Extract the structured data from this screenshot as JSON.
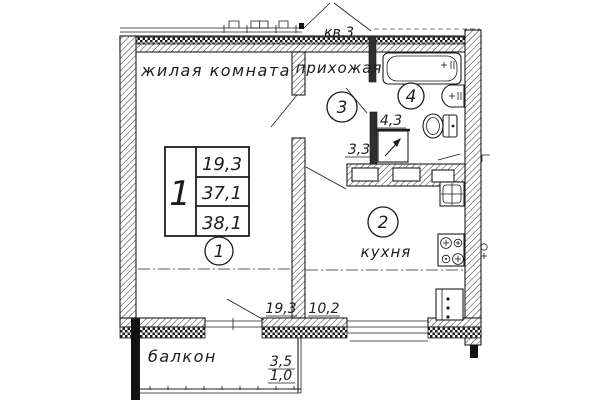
{
  "apartment": {
    "label": "кв.3"
  },
  "rooms": {
    "living": {
      "name": "жилая комната",
      "number": "1",
      "area": "19,3"
    },
    "kitchen": {
      "name": "кухня",
      "number": "2",
      "area": "10,2"
    },
    "hall": {
      "name": "прихожая",
      "number": "3",
      "area": "3,3",
      "wardrobe_area": "4,3"
    },
    "bath": {
      "number": "4"
    }
  },
  "info_table": {
    "flat_no": "1",
    "living_area": "19,3",
    "total_area": "37,1",
    "total_area_with_balcony": "38,1"
  },
  "balcony": {
    "name": "балкон",
    "area": "3,5",
    "area_coeff": "1,0"
  },
  "colors": {
    "ink": "#1c1c1c",
    "paper": "#ffffff"
  }
}
